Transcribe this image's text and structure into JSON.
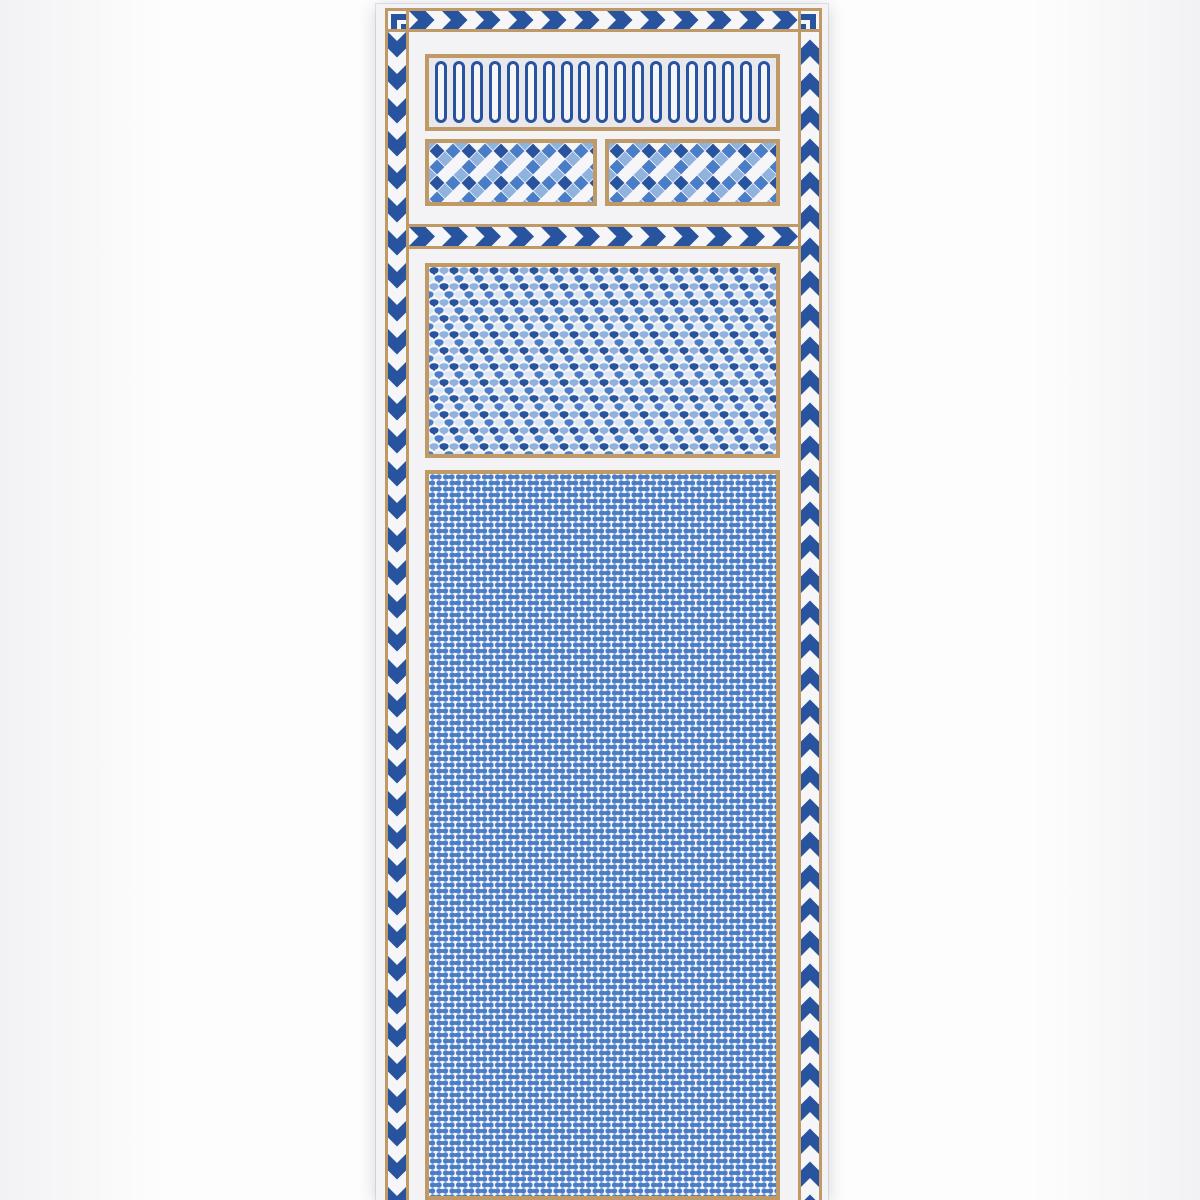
{
  "meta": {
    "content_type": "photograph of a decorative wallpaper panel",
    "visible_text": "",
    "alt": "Tall blue-and-white geometric wallpaper panel: chevron borders, arched ring frieze, diamond checker bands, chevron divider, fan-scale band and a bone-lattice field"
  },
  "palette": {
    "navy": "#27539f",
    "medium_blue": "#4a7dc8",
    "light_blue": "#8fb3de",
    "pale_blue": "#dde7f3",
    "tan": "#bf9a66",
    "paper_white": "#f3f2f4",
    "pattern_ground": "#f6f5f7",
    "arch_ground": "#e9e8ec",
    "photo_margin": "#fcfcfc"
  },
  "panel": {
    "borders": {
      "top": {
        "pattern": "chevron",
        "direction": "right"
      },
      "left": {
        "pattern": "chevron",
        "direction": "down"
      },
      "right": {
        "pattern": "chevron",
        "direction": "up"
      }
    },
    "sections": [
      {
        "name": "arch-frieze",
        "pattern": "stadium-rings",
        "ring_count": 19
      },
      {
        "name": "diamond-band-left",
        "pattern": "diamond-checker"
      },
      {
        "name": "diamond-band-right",
        "pattern": "diamond-checker"
      },
      {
        "name": "chevron-divider",
        "pattern": "chevron",
        "direction": "right"
      },
      {
        "name": "fan-scale-panel",
        "pattern": "scallop-fans"
      },
      {
        "name": "bone-lattice-panel",
        "pattern": "bone-lattice"
      }
    ]
  }
}
